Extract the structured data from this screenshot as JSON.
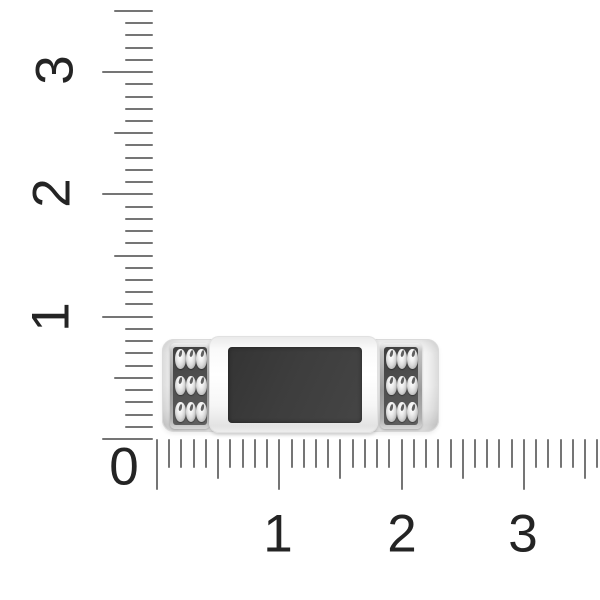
{
  "colors": {
    "background": "#ffffff",
    "tick": "#757575",
    "number": "#242424",
    "stone": "#3d3d3d",
    "panel_dark": "#4f4f4f",
    "metal_light": "#f6f6f6"
  },
  "rulers": {
    "vertical": {
      "labels": [
        "3",
        "2",
        "1"
      ],
      "min": 0,
      "max": 3.5,
      "step": 0.1
    },
    "horizontal": {
      "labels": [
        "1",
        "2",
        "3"
      ],
      "min": 0,
      "max": 3.6,
      "step": 0.1
    },
    "origin_label": "0"
  },
  "object": {
    "type": "ring top view",
    "center": "black rectangular onyx inlay in polished white-gold frame",
    "sides": "two dark panels each with 3x3 polished oval beads",
    "bead_rows": 3,
    "bead_cols": 3
  }
}
